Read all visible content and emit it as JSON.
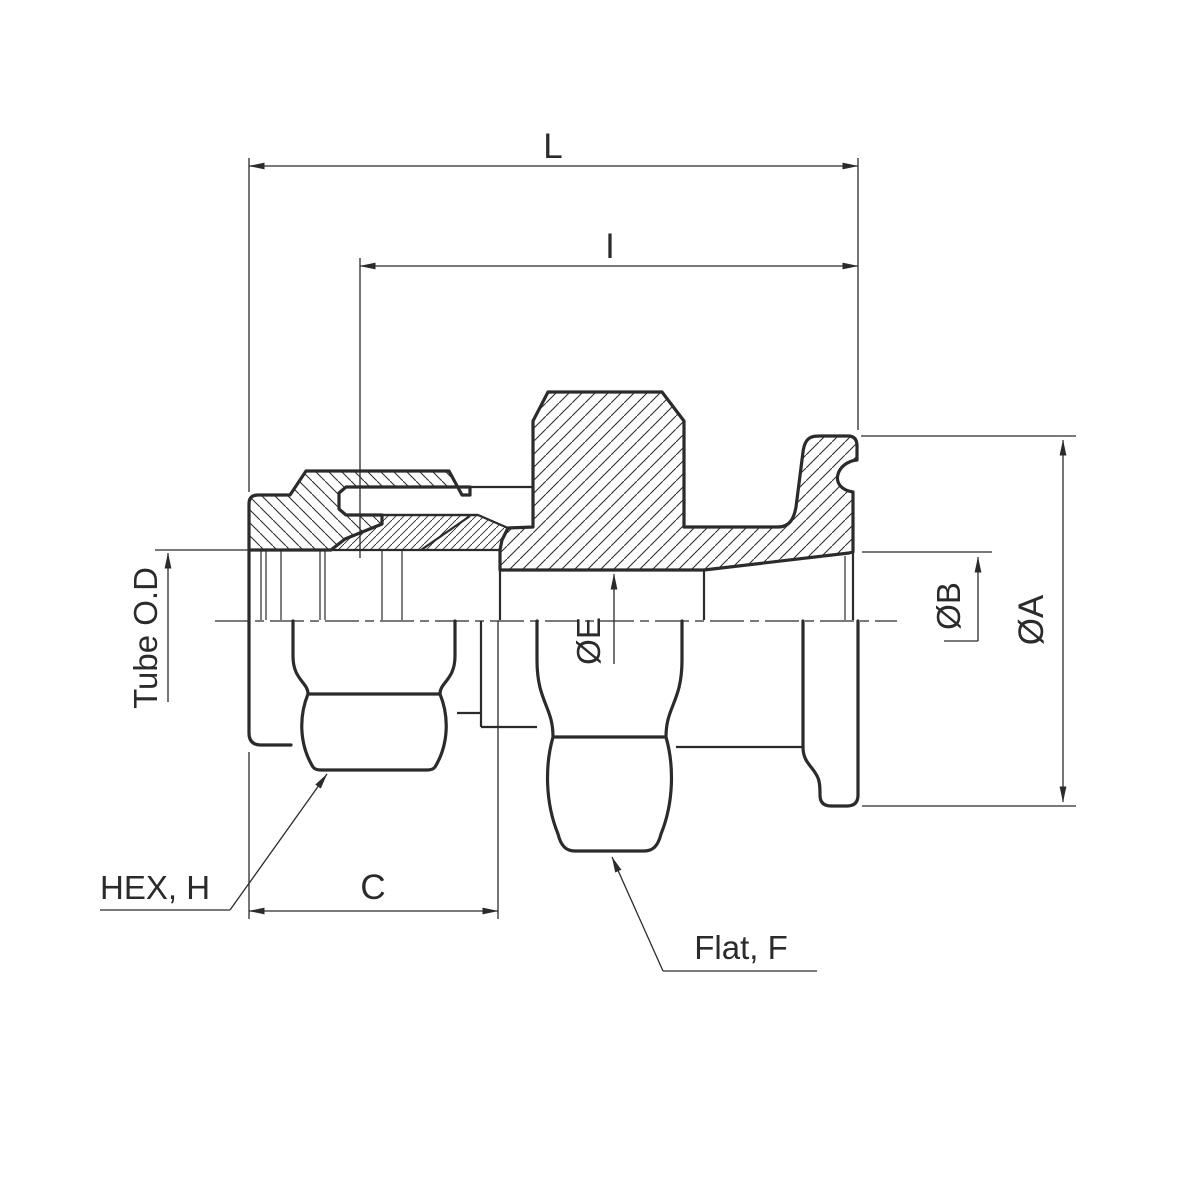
{
  "drawing": {
    "type": "engineering-cross-section",
    "subject": "tube-compression-fitting-to-flange-adapter",
    "colors": {
      "ink": "#2b2b2b",
      "paper": "#ffffff"
    },
    "labels": {
      "overall_length": "L",
      "insertion_length": "I",
      "tube_od": "Tube O.D",
      "bore_diameter": "ØE",
      "flange_bore_diameter": "ØB",
      "flange_outer_diameter": "ØA",
      "hex": "HEX, H",
      "nut_length": "C",
      "flat": "Flat, F"
    }
  }
}
